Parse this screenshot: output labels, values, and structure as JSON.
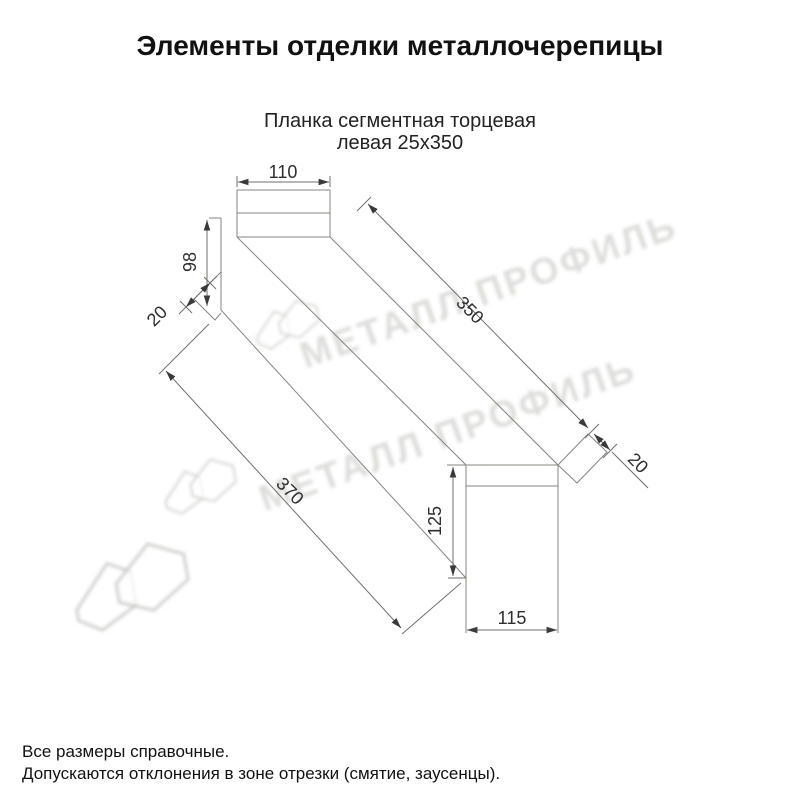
{
  "page": {
    "title": "Элементы отделки металлочерепицы"
  },
  "product": {
    "subtitle_line1": "Планка сегментная торцевая",
    "subtitle_line2": "левая 25х350"
  },
  "dimensions": {
    "flange_width": "110",
    "web_height": "98",
    "left_hem": "20",
    "top_length": "350",
    "right_hem": "20",
    "bottom_length": "370",
    "end_height": "125",
    "end_width": "115"
  },
  "watermark": {
    "brand": "МЕТАЛЛ ПРОФИЛЬ"
  },
  "footer": {
    "line1": "Все размеры справочные.",
    "line2": "Допускаются отклонения в зоне отрезки (смятие, заусенцы)."
  },
  "colors": {
    "line": "#85857f",
    "dim_text": "#2e2e2e",
    "title_text": "#1a1a1a",
    "watermark": "#c9c9c4"
  }
}
